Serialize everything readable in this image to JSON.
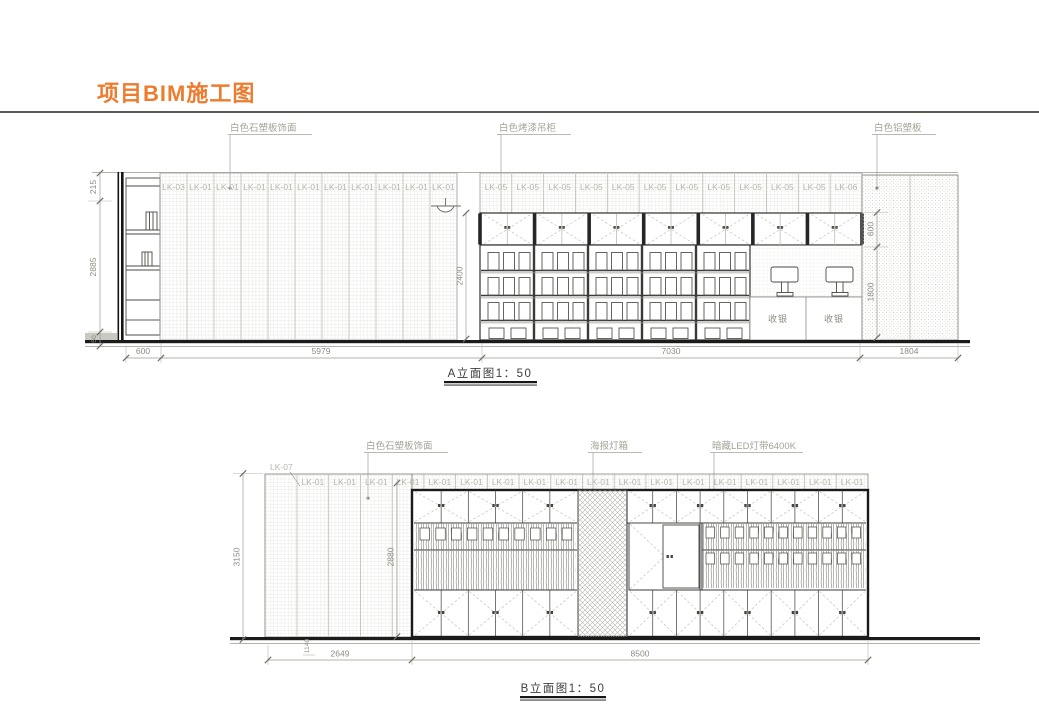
{
  "page": {
    "title": "项目BIM施工图",
    "accent_color": "#ED7C2F"
  },
  "elevation_a": {
    "caption": "A立面图1：50",
    "annotations": {
      "finish": "白色石塑板饰面",
      "cabinet": "白色烤漆吊柜",
      "alu_panel": "白色铝塑板"
    },
    "panel_labels_wall": [
      "LK-03",
      "LK-01",
      "LK-01",
      "LK-01",
      "LK-01",
      "LK-01",
      "LK-01",
      "LK-01",
      "LK-01",
      "LK-01",
      "LK-01"
    ],
    "panel_labels_cabinets": [
      "LK-05",
      "LK-05",
      "LK-05",
      "LK-05",
      "LK-05",
      "LK-05",
      "LK-05",
      "LK-05",
      "LK-05",
      "LK-05",
      "LK-05",
      "LK-06"
    ],
    "cashier_label": "收银",
    "dims": {
      "height_top": "215",
      "height_wall": "2885",
      "skirting": "50",
      "width_cabinet": "600",
      "width_wall": "5979",
      "width_shelving": "7030",
      "width_panel": "1804",
      "height_opening": "2400",
      "height_upper": "600",
      "height_lower": "1800"
    }
  },
  "elevation_b": {
    "caption": "B立面图1：50",
    "annotations": {
      "finish": "白色石塑板饰面",
      "lightbox": "海报灯箱",
      "led": "暗藏LED灯带6400K"
    },
    "corner_label": "LK-07",
    "panel_labels": [
      "LK-01",
      "LK-01",
      "LK-01",
      "LK-01",
      "LK-01",
      "LK-01",
      "LK-01",
      "LK-01",
      "LK-01",
      "LK-01",
      "LK-01",
      "LK-01",
      "LK-01",
      "LK-01",
      "LK-01",
      "LK-01",
      "LK-01",
      "LK-01"
    ],
    "dims": {
      "height_total": "3150",
      "height_unit": "2880",
      "height_small": "1140",
      "width_left": "2649",
      "width_unit": "8500"
    }
  }
}
